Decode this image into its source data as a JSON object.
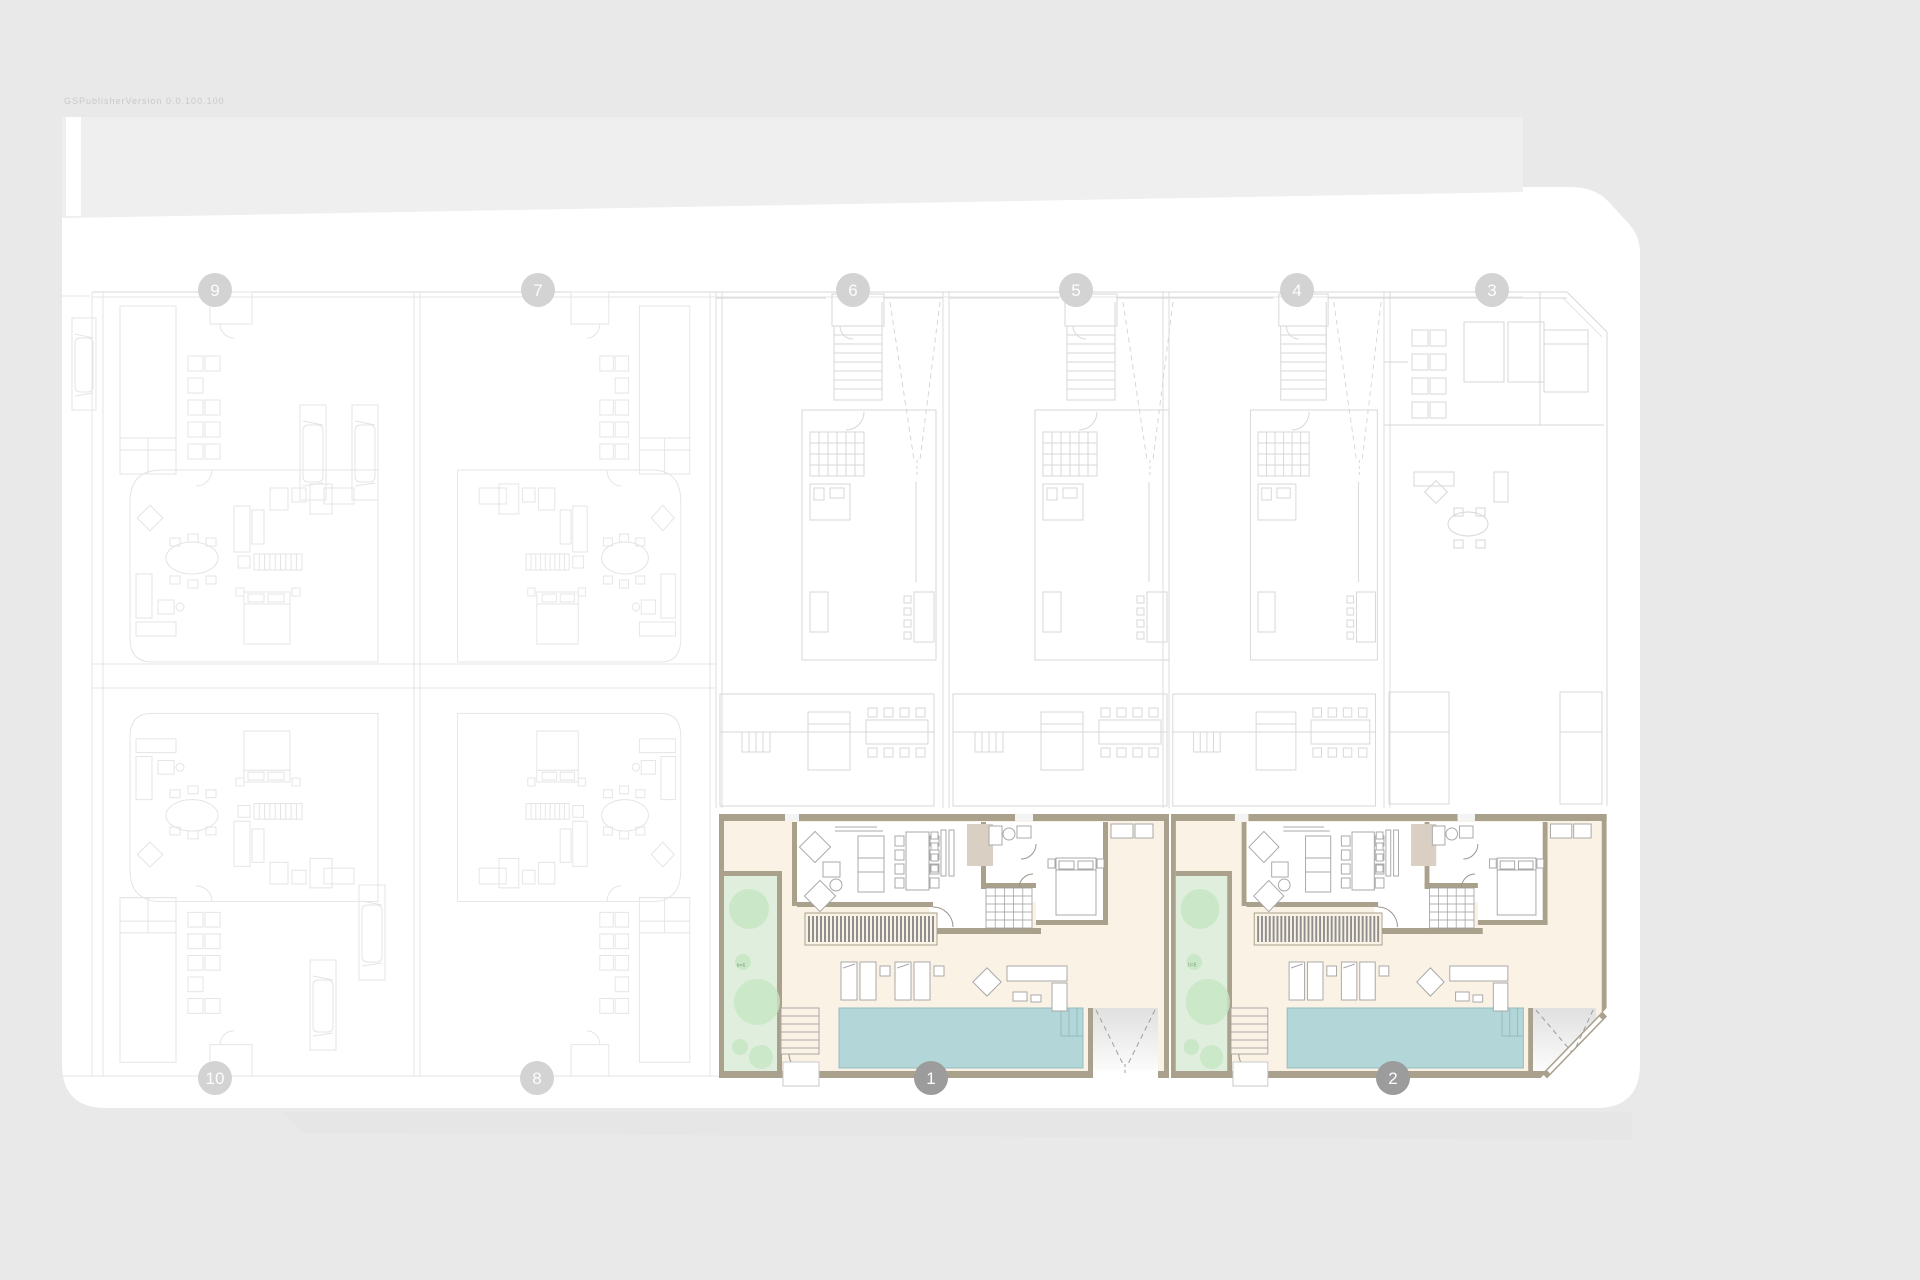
{
  "watermark": "GSPublisherVersion 0.0.100.100",
  "garden_note": "h=6",
  "colors": {
    "background": "#e9e9e9",
    "sidewalk_band_top": "#efefef",
    "sidewalk_band_bottom": "#e6e6e6",
    "plate": "#ffffff",
    "faint_line": "#e4e4e4",
    "mid_line": "#d7d7d7",
    "boundary_line": "#dedede",
    "wall": "#a9a18c",
    "floor": "#fbf2e6",
    "room": "#ffffff",
    "pool": "#b3d6d9",
    "pool_edge": "#93bcc0",
    "garden": "#e0efdd",
    "tree": "#c6e6c3",
    "taupe": "#dacfc3",
    "louver": "#8e8e8e",
    "furniture_line": "#a8a8a8",
    "detail_line": "#9b958b",
    "hatch_line": "#9a9a9a",
    "dash_line": "#9e9e9e",
    "marker_light": "#d3d3d3",
    "marker_dark": "#9c9c9c",
    "marker_text": "#fdfdfd",
    "watermark": "#c9c9c9",
    "garden_note_color": "#7fa07f"
  },
  "grid_markers": {
    "top_y": 290,
    "top": [
      {
        "label": "9",
        "x": 215
      },
      {
        "label": "7",
        "x": 538
      },
      {
        "label": "6",
        "x": 853
      },
      {
        "label": "5",
        "x": 1076
      },
      {
        "label": "4",
        "x": 1297
      },
      {
        "label": "3",
        "x": 1492
      }
    ],
    "bottom_y": 1078,
    "bottom_light": [
      {
        "label": "10",
        "x": 215
      },
      {
        "label": "8",
        "x": 537
      }
    ],
    "bottom_dark": [
      {
        "label": "1",
        "x": 931
      },
      {
        "label": "2",
        "x": 1393
      }
    ]
  },
  "highlighted_units": [
    {
      "label": "1",
      "x": 719,
      "scale": 1.0,
      "chamfer": false
    },
    {
      "label": "2",
      "x": 1171,
      "scale": 0.968,
      "chamfer": true
    }
  ]
}
